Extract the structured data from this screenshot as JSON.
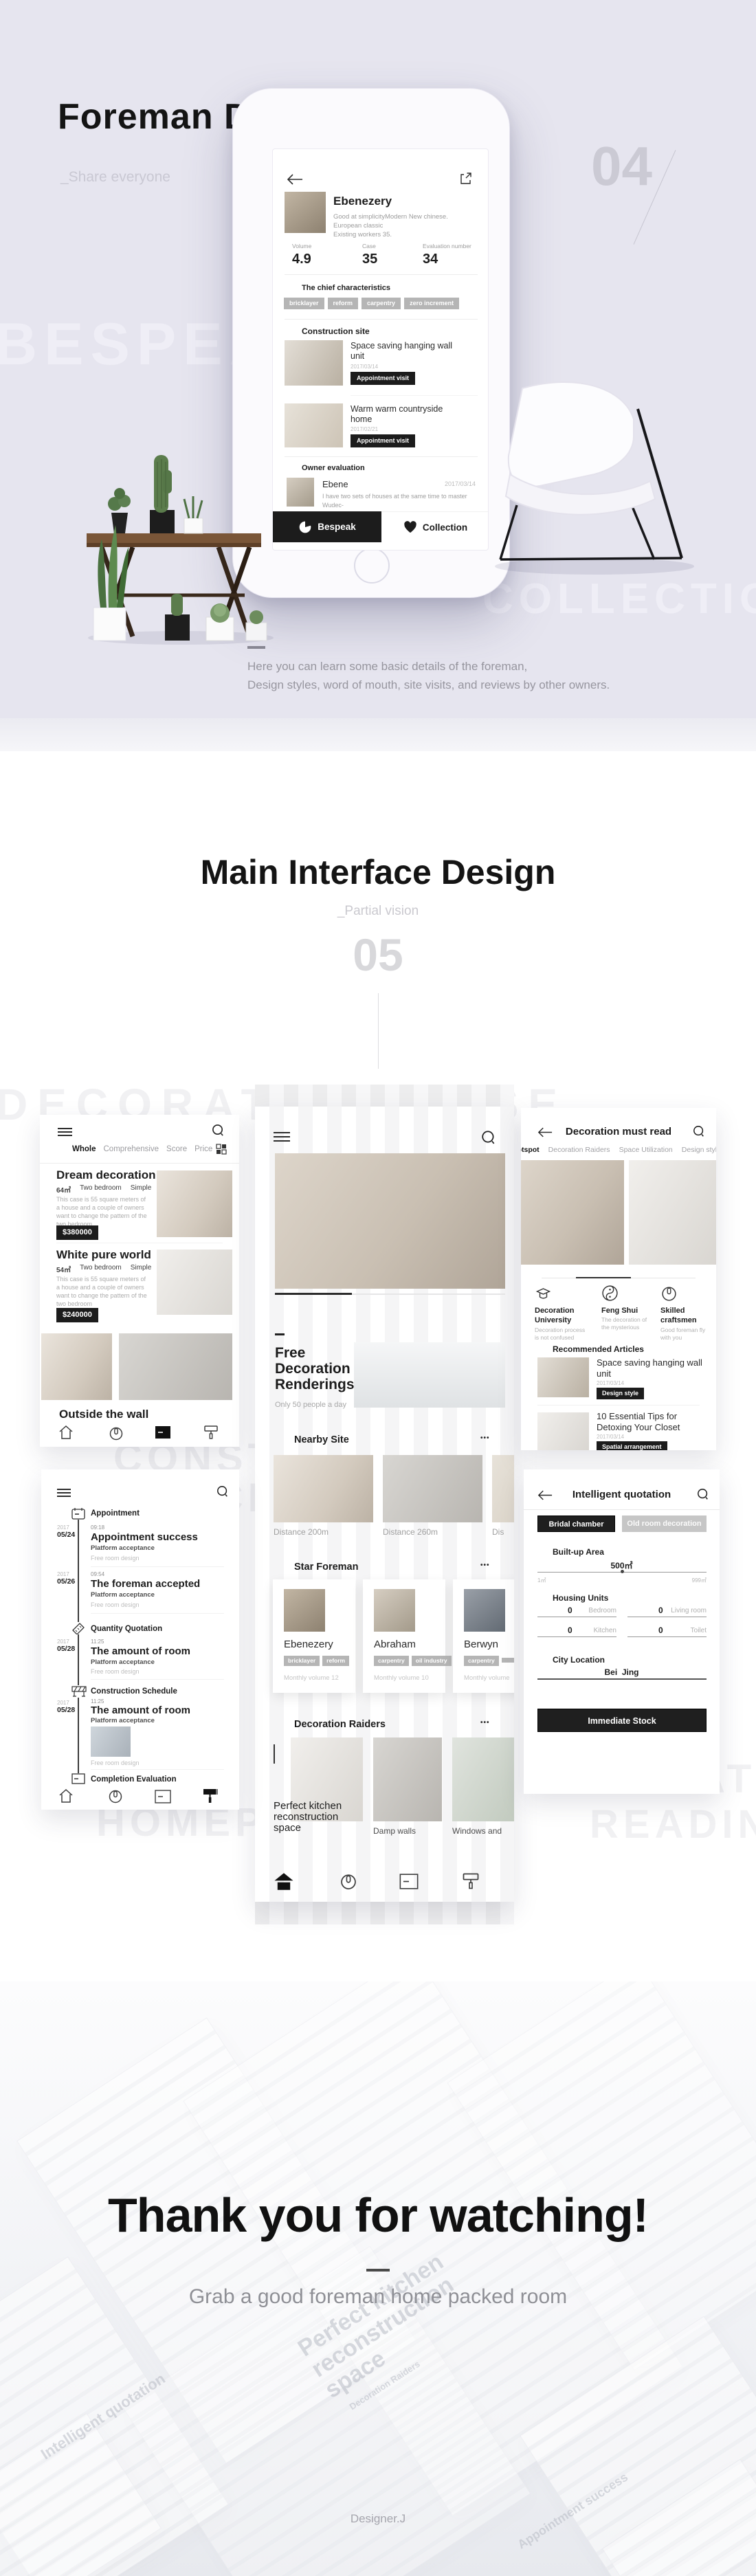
{
  "foreman": {
    "title": "Foreman Details",
    "subtitle": "_Share everyone",
    "index": "04",
    "ghost_left": "BESPEAK",
    "ghost_right": "COLLECTION",
    "caption1": "Here you can learn some basic details of the foreman,",
    "caption2": "Design styles, word of mouth, site visits, and reviews by other owners.",
    "phone": {
      "name": "Ebenezery",
      "desc1": "Good at simplicityModern New chinese.",
      "desc2": "European classic",
      "desc3": "Existing workers 35.",
      "stats": [
        {
          "label": "Volume",
          "value": "4.9"
        },
        {
          "label": "Case",
          "value": "35"
        },
        {
          "label": "Evaluation number",
          "value": "34"
        }
      ],
      "characteristics": {
        "title": "The chief characteristics",
        "tags": [
          "bricklayer",
          "reform",
          "carpentry",
          "zero increment"
        ]
      },
      "construction": {
        "title": "Construction site",
        "items": [
          {
            "title": "Space saving hanging wall unit",
            "date": "2017/03/14",
            "button": "Appointment visit"
          },
          {
            "title": "Warm warm countryside home",
            "date": "2017/02/21",
            "button": "Appointment visit"
          }
        ]
      },
      "evaluation": {
        "title": "Owner evaluation",
        "reviewer": "Ebene",
        "date": "2017/03/14",
        "line1": "I have two sets of houses at the same time to master Wudec-",
        "line2": "oration, very satisfied"
      },
      "actions": {
        "bespeak": "Bespeak",
        "collection": "Collection"
      }
    }
  },
  "main": {
    "title": "Main Interface Design",
    "subtitle": "_Partial vision",
    "index": "05",
    "ghosts": {
      "g1": "DECORATION CASE",
      "g2": "CONSTRUCTION",
      "g3": "PROCESS",
      "g4": "HOMEPAGE",
      "g5": "AT",
      "g6": "READING"
    },
    "case_screen": {
      "tabs": [
        "Whole",
        "Comprehensive",
        "Score",
        "Price"
      ],
      "items": [
        {
          "title": "Dream decoration",
          "area": "64㎡",
          "rooms": "Two bedroom",
          "style": "Simple",
          "desc": "This case is 55 square meters of a house and a couple of owners want to change the pattern of the two bedroom",
          "price": "$380000"
        },
        {
          "title": "White pure world",
          "area": "54㎡",
          "rooms": "Two bedroom",
          "style": "Simple",
          "desc": "This case is 55 square meters of a house and a couple of owners want to change the pattern of the two bedroom",
          "price": "$240000"
        }
      ],
      "bottom_title": "Outside the wall"
    },
    "home_screen": {
      "free": {
        "title": "Free Decoration Renderings",
        "sub": "Only 50 people a day"
      },
      "nearby": {
        "title": "Nearby Site",
        "more": "•••",
        "items": [
          "Distance 200m",
          "Distance 260m",
          "Dis"
        ]
      },
      "star": {
        "title": "Star Foreman",
        "more": "•••",
        "foremen": [
          {
            "name": "Ebenezery",
            "tags": [
              "bricklayer",
              "reform"
            ],
            "volume": "Monthly volume 12"
          },
          {
            "name": "Abraham",
            "tags": [
              "carpentry",
              "oil industry"
            ],
            "volume": "Monthly volume 10"
          },
          {
            "name": "Berwyn",
            "tags": [
              "carpentry"
            ],
            "volume": "Monthly volume"
          }
        ]
      },
      "raiders": {
        "title": "Decoration Raiders",
        "more": "•••",
        "items": [
          "Perfect kitchen reconstruction space",
          "Damp walls",
          "Windows and"
        ]
      }
    },
    "read_screen": {
      "title": "Decoration must read",
      "tabs": [
        "Hotspot",
        "Decoration Raiders",
        "Space Utilization",
        "Design style"
      ],
      "features": [
        {
          "title": "Decoration University",
          "sub": "Decoration process is not confused"
        },
        {
          "title": "Feng Shui",
          "sub": "The decoration of the mysterious"
        },
        {
          "title": "Skilled craftsmen",
          "sub": "Good foreman fly with you"
        }
      ],
      "recommended": {
        "title": "Recommended Articles",
        "articles": [
          {
            "title": "Space saving hanging wall unit",
            "date": "2017/03/14",
            "tag": "Design style"
          },
          {
            "title": "10 Essential Tips for Detoxing Your Closet",
            "date": "2017/03/14",
            "tag": "Spatial arrangement"
          }
        ]
      }
    },
    "schedule_screen": {
      "groups": [
        {
          "title": "Appointment"
        },
        {
          "title": "Quantity Quotation"
        },
        {
          "title": "Construction Schedule"
        },
        {
          "title": "Completion Evaluation"
        }
      ],
      "entries": [
        {
          "year": "2017",
          "date": "05/24",
          "time": "09:18",
          "title": "Appointment success",
          "sub": "Platform acceptance",
          "note": "Free room design"
        },
        {
          "year": "2017",
          "date": "05/26",
          "time": "09:54",
          "title": "The foreman accepted",
          "sub": "Platform acceptance",
          "note": "Free room design"
        },
        {
          "year": "2017",
          "date": "05/28",
          "time": "11:25",
          "title": "The amount of room",
          "sub": "Platform acceptance",
          "note": "Free room design"
        },
        {
          "year": "2017",
          "date": "05/28",
          "time": "11:25",
          "title": "The amount of room",
          "sub": "Platform acceptance",
          "note": "Free room design"
        }
      ]
    },
    "quote_screen": {
      "title": "Intelligent quotation",
      "toggle": [
        "Bridal chamber",
        "Old room decoration"
      ],
      "area": {
        "label": "Built-up Area",
        "value": "500㎡",
        "min": "1㎡",
        "max": "999㎡"
      },
      "units": {
        "label": "Housing Units",
        "fields": [
          {
            "value": "0",
            "label": "Bedroom"
          },
          {
            "value": "0",
            "label": "Living room"
          },
          {
            "value": "0",
            "label": "Kitchen"
          },
          {
            "value": "0",
            "label": "Toilet"
          }
        ]
      },
      "city": {
        "label": "City Location",
        "value": "Bei  Jing"
      },
      "submit": "Immediate Stock"
    }
  },
  "thanks": {
    "title": "Thank you for watching!",
    "subtitle": "Grab a good foreman home packed room",
    "designer": "Designer.J",
    "ghost1": "Perfect kitchen reconstruction space",
    "ghost2": "Decoration Raiders",
    "ghost3": "Intelligent quotation",
    "ghost4": "Appointment success"
  },
  "colors": {
    "accent_black": "#1c1c1c",
    "lavender_bg": "#e6e5ef",
    "tag_gray": "#b5b5b5",
    "ghost_gray": "#f1f1f3"
  }
}
